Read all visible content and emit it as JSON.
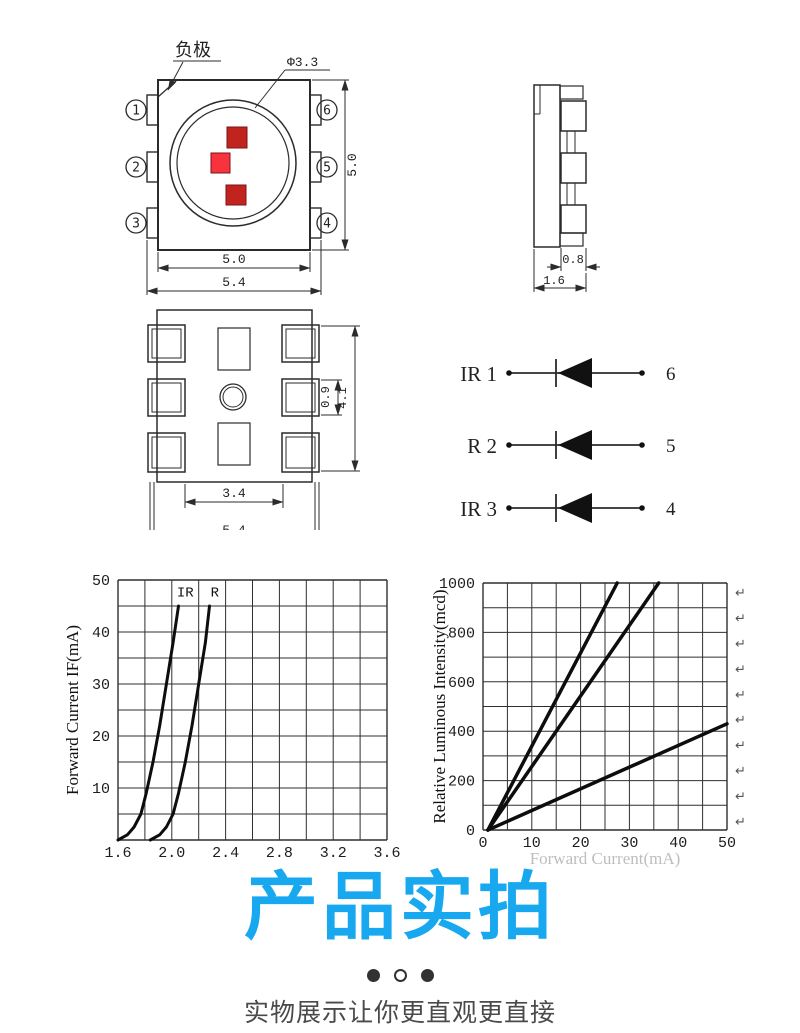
{
  "colors": {
    "accent_blue": "#18a8f0",
    "chip_dark_red": "#c1241f",
    "chip_bright_red": "#f8333e",
    "line_color": "#2b2b2b"
  },
  "top_view": {
    "negative_terminal_label": "负极",
    "lens_diameter": "Φ3.3",
    "pins_left": [
      "1",
      "2",
      "3"
    ],
    "pins_right": [
      "6",
      "5",
      "4"
    ],
    "dim_side_height": "5.0",
    "dim_bottom_inner": "5.0",
    "dim_bottom_outer": "5.4"
  },
  "side_view": {
    "dim_pad_width": "0.8",
    "dim_body_width": "1.6"
  },
  "bottom_view": {
    "dim_inner_width": "3.4",
    "dim_outer_width": "5.4",
    "dim_pad_height": "0.9",
    "dim_pads_span": "4.1"
  },
  "circuit": {
    "rows": [
      {
        "channel": "IR 1",
        "pin": "6"
      },
      {
        "channel": "R 2",
        "pin": "5"
      },
      {
        "channel": "IR 3",
        "pin": "4"
      }
    ]
  },
  "chart_data": [
    {
      "type": "line",
      "xlabel": "",
      "ylabel": "Forward Current IF(mA)",
      "xlim": [
        1.6,
        3.6
      ],
      "ylim": [
        0,
        50
      ],
      "x_ticks": [
        "1.6",
        "2.0",
        "2.4",
        "2.8",
        "3.2",
        "3.6"
      ],
      "y_ticks": [
        "10",
        "20",
        "30",
        "40",
        "50"
      ],
      "x_grid_step": 0.2,
      "y_grid_step": 5,
      "grid": true,
      "legend_position": "in-plot-top",
      "annotations": [
        {
          "text": "IR",
          "x": 2.1,
          "y": 46.8
        },
        {
          "text": "R",
          "x": 2.32,
          "y": 46.8
        }
      ],
      "series": [
        {
          "name": "IR",
          "points": [
            [
              1.6,
              0
            ],
            [
              1.67,
              1
            ],
            [
              1.72,
              2.5
            ],
            [
              1.77,
              5
            ],
            [
              1.81,
              9
            ],
            [
              1.86,
              15
            ],
            [
              1.91,
              22
            ],
            [
              1.96,
              30
            ],
            [
              2.01,
              38
            ],
            [
              2.05,
              45
            ]
          ]
        },
        {
          "name": "R",
          "points": [
            [
              1.84,
              0
            ],
            [
              1.91,
              1
            ],
            [
              1.96,
              2.5
            ],
            [
              2.01,
              5
            ],
            [
              2.05,
              9
            ],
            [
              2.1,
              15
            ],
            [
              2.15,
              22
            ],
            [
              2.2,
              30
            ],
            [
              2.25,
              38
            ],
            [
              2.28,
              45
            ]
          ]
        }
      ]
    },
    {
      "type": "line",
      "xlabel": "Forward Current(mA)",
      "ylabel": "Relative Luminous Intensity(mcd)",
      "xlim": [
        0,
        50
      ],
      "ylim": [
        0,
        1000
      ],
      "x_ticks": [
        "0",
        "10",
        "20",
        "30",
        "40",
        "50"
      ],
      "y_ticks": [
        "0",
        "200",
        "400",
        "600",
        "800",
        "1000"
      ],
      "x_grid_step": 5,
      "y_grid_step": 100,
      "grid": true,
      "series": [
        {
          "name": "line-steep",
          "points": [
            [
              1,
              0
            ],
            [
              27.5,
              1000
            ]
          ]
        },
        {
          "name": "line-middle",
          "points": [
            [
              1,
              0
            ],
            [
              36,
              1000
            ]
          ]
        },
        {
          "name": "line-shallow",
          "points": [
            [
              1,
              0
            ],
            [
              50,
              430
            ]
          ]
        }
      ],
      "return_marks": {
        "char": "↵",
        "count": 10
      }
    }
  ],
  "footer": {
    "heading": "产品实拍",
    "caption": "实物展示让你更直观更直接",
    "dots": [
      "filled",
      "open",
      "filled"
    ]
  }
}
